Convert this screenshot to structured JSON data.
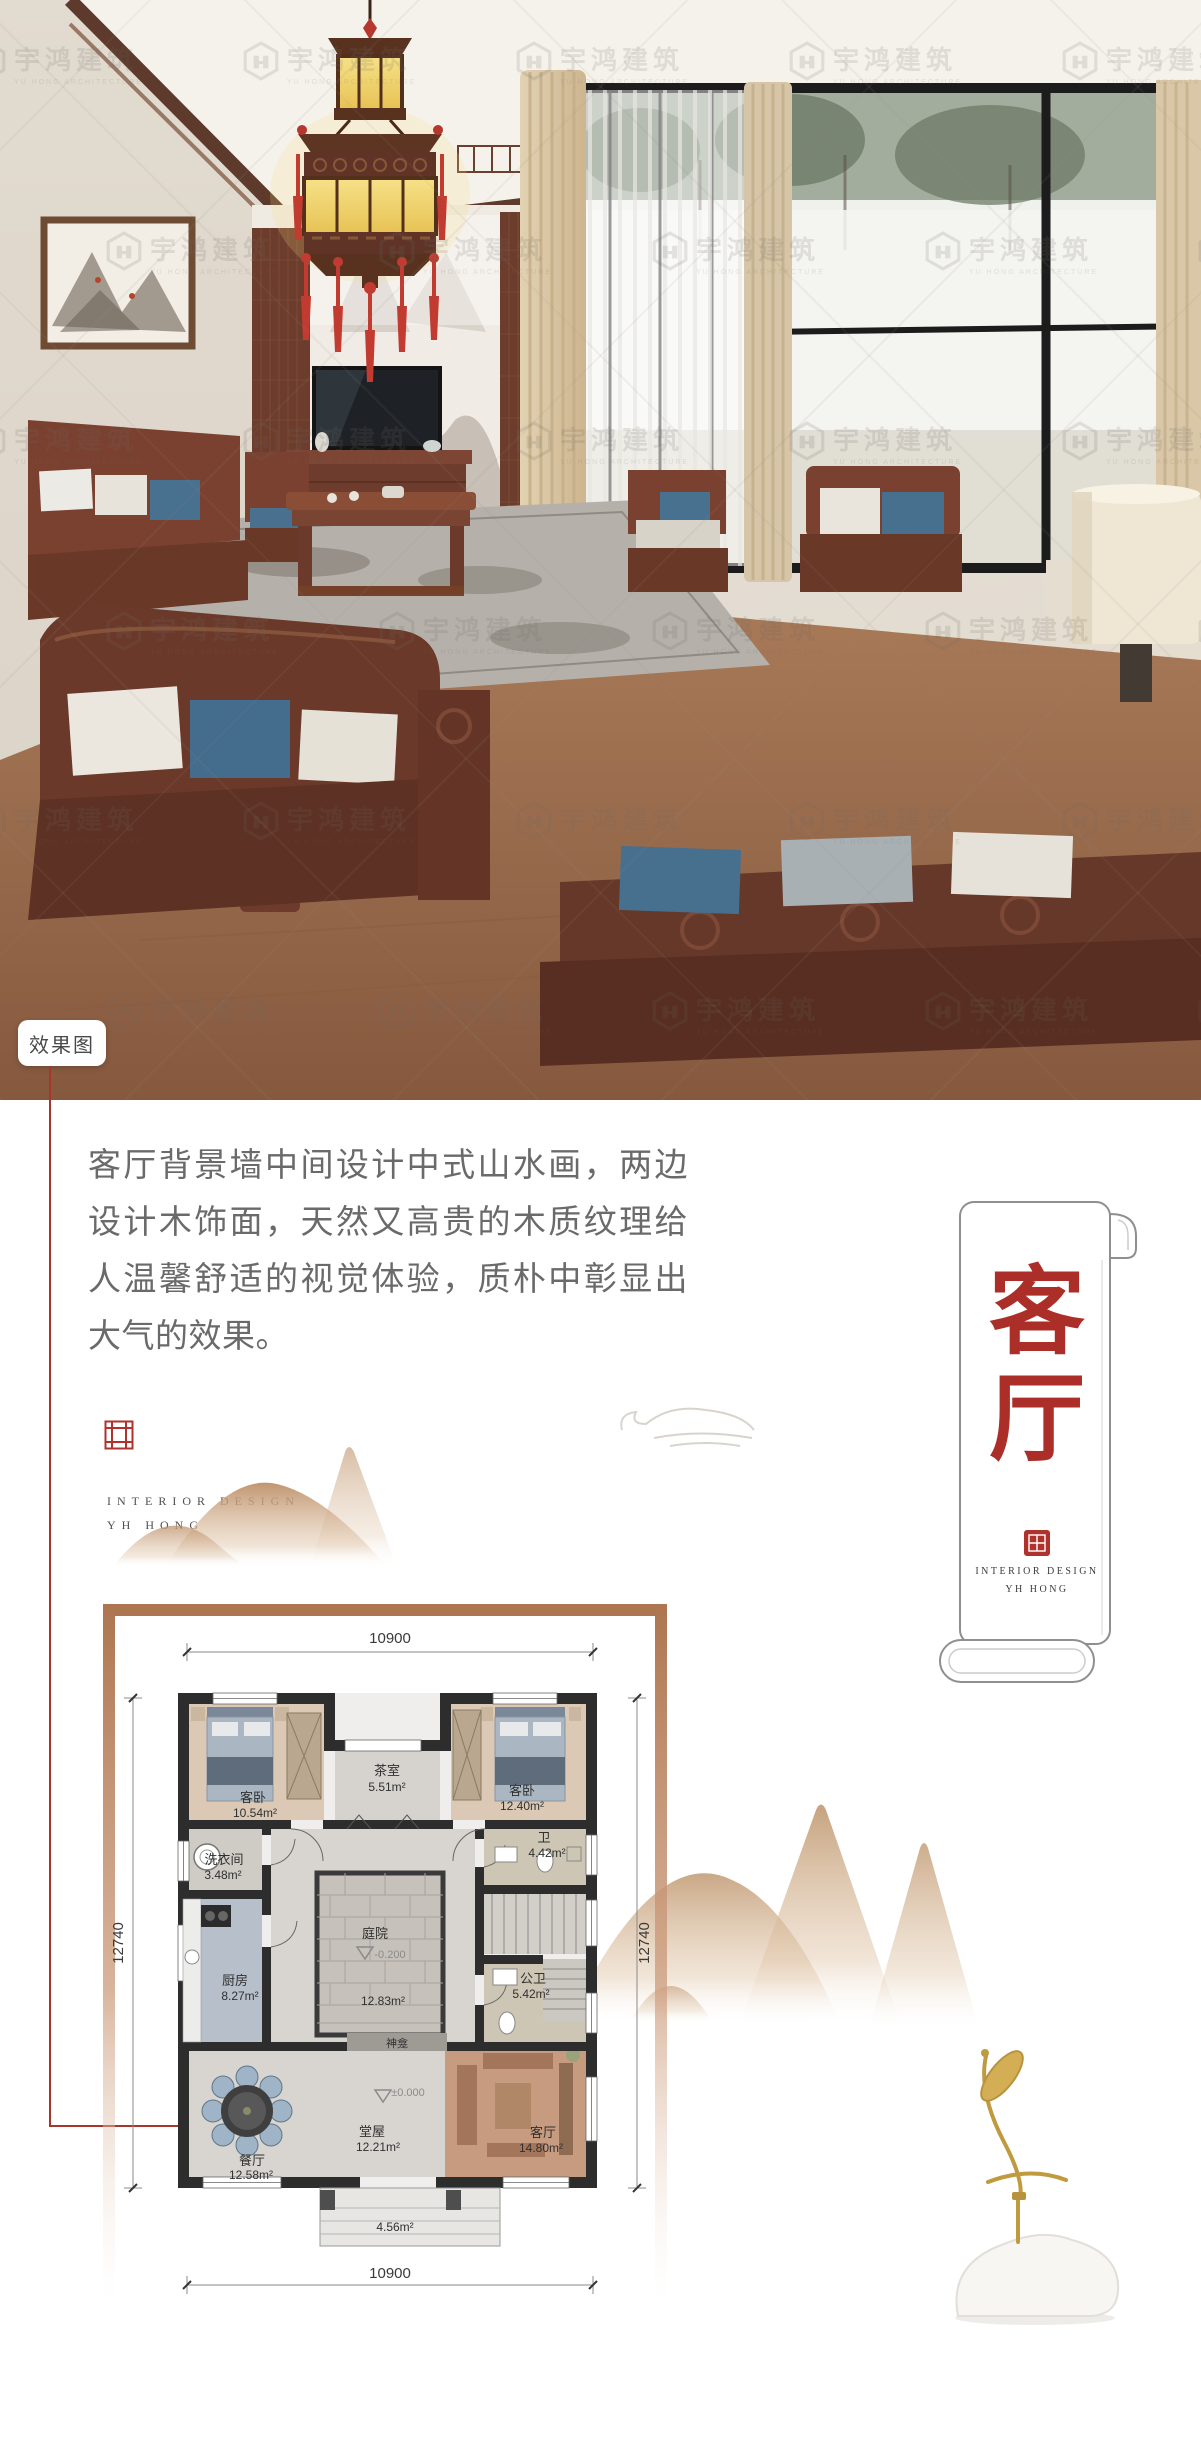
{
  "watermark": {
    "name": "宇鸿建筑",
    "sub": "YU HONG ARCHITECTURE"
  },
  "photo": {
    "tag": "效果图"
  },
  "intro": {
    "text": "客厅背景墙中间设计中式山水画，两边设计木饰面，天然又高贵的木质纹理给人温馨舒适的视觉体验，质朴中彰显出大气的效果。"
  },
  "brand": {
    "line1": "INTERIOR DESIGN",
    "line2": "YH HONG"
  },
  "scroll": {
    "char1": "客",
    "char2": "厅",
    "brand1": "INTERIOR DESIGN",
    "brand2": "YH HONG"
  },
  "plan": {
    "dims": {
      "top": "10900",
      "bottom": "10900",
      "left": "12740",
      "right": "12740"
    },
    "rooms": {
      "bedroom1": {
        "name": "客卧",
        "area": "10.54m²"
      },
      "tearoom": {
        "name": "茶室",
        "area": "5.51m²"
      },
      "bedroom2": {
        "name": "客卧",
        "area": "12.40m²"
      },
      "laundry": {
        "name": "洗衣间",
        "area": "3.48m²"
      },
      "bath": {
        "name": "卫",
        "area": "4.42m²"
      },
      "kitchen": {
        "name": "厨房",
        "area": "8.27m²"
      },
      "courtyard": {
        "name": "庭院",
        "level": "-0.200",
        "area": "12.83m²"
      },
      "guestbath": {
        "name": "公卫",
        "area": "5.42m²"
      },
      "shrine": {
        "name": "神龛"
      },
      "hall": {
        "name": "堂屋",
        "level": "±0.000",
        "area": "12.21m²"
      },
      "dining": {
        "name": "餐厅",
        "area": "12.58m²"
      },
      "living": {
        "name": "客厅",
        "area": "14.80m²"
      },
      "porch": {
        "area": "4.56m²"
      }
    }
  },
  "colors": {
    "accent_red": "#b0322c",
    "line_red": "#a8352c",
    "frame_brown": "#ad7550",
    "mountain_tan": "#c09870"
  }
}
